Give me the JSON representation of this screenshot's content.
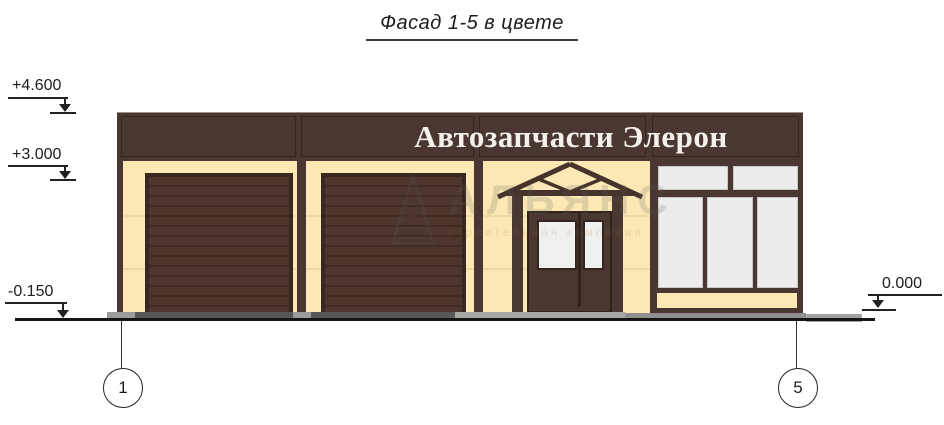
{
  "drawing": {
    "title": "Фасад 1-5 в цвете",
    "sign_text": "Автозапчасти Элерон",
    "elevation_marks": {
      "parapet_top": "+4.600",
      "canopy_level": "+3.000",
      "ground_left": "-0.150",
      "ground_right": "0.000"
    },
    "axis_markers": {
      "left": "1",
      "right": "5"
    }
  },
  "watermark": {
    "name": "АЛЬЯНС",
    "subtitle": "строительная компания"
  },
  "colors": {
    "brown": "#4b3731",
    "brown_dark": "#38271f",
    "cream": "#fce8b4",
    "glass": "#ececec",
    "pavement_dark": "#58585a",
    "pavement_light": "#9b9b9b",
    "ramp": "#a8a7a3",
    "line": "#141414",
    "sign_text": "#f4f0ea"
  }
}
